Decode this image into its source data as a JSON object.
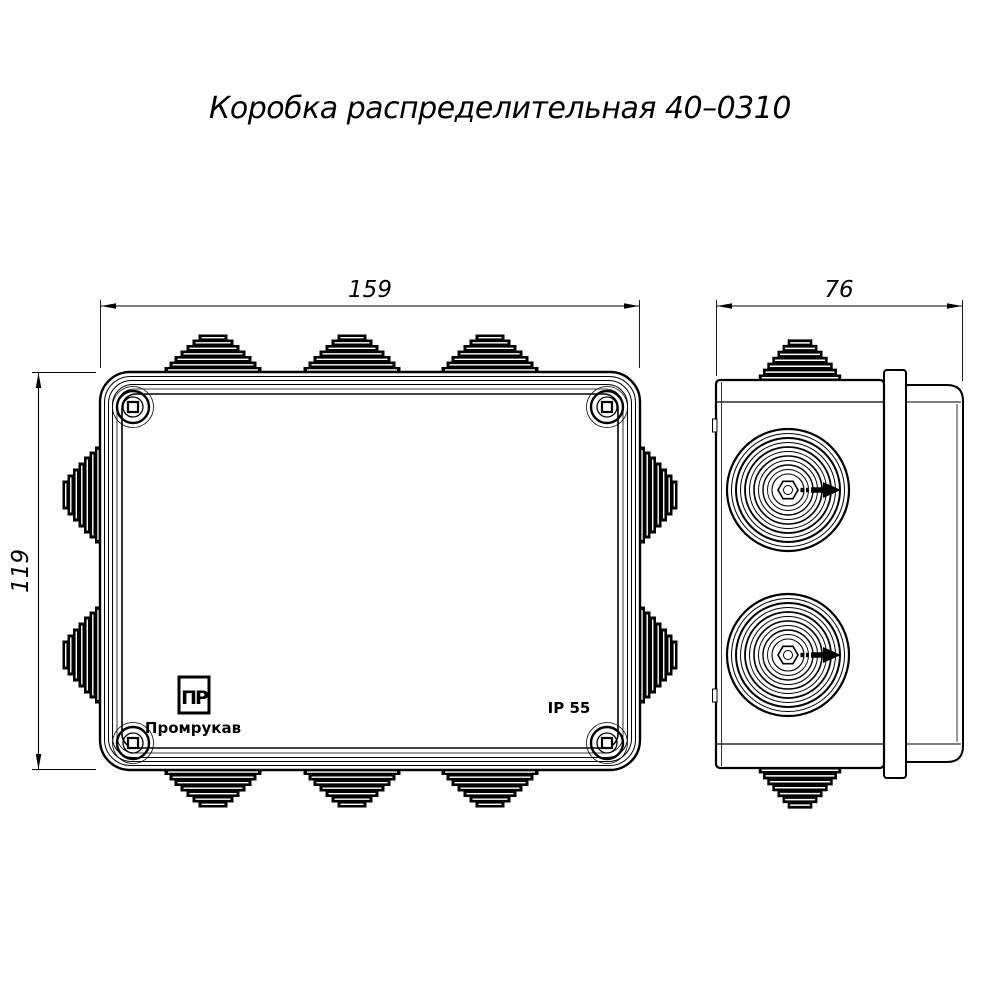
{
  "title": "Коробка распределительная 40–0310",
  "dimensions": {
    "width_mm": "159",
    "depth_mm": "76",
    "height_mm": "119"
  },
  "markings": {
    "logo_monogram": "ПР",
    "brand": "Промрукав",
    "ip_rating": "IP 55"
  },
  "colors": {
    "line": "#000000",
    "background": "#ffffff"
  }
}
